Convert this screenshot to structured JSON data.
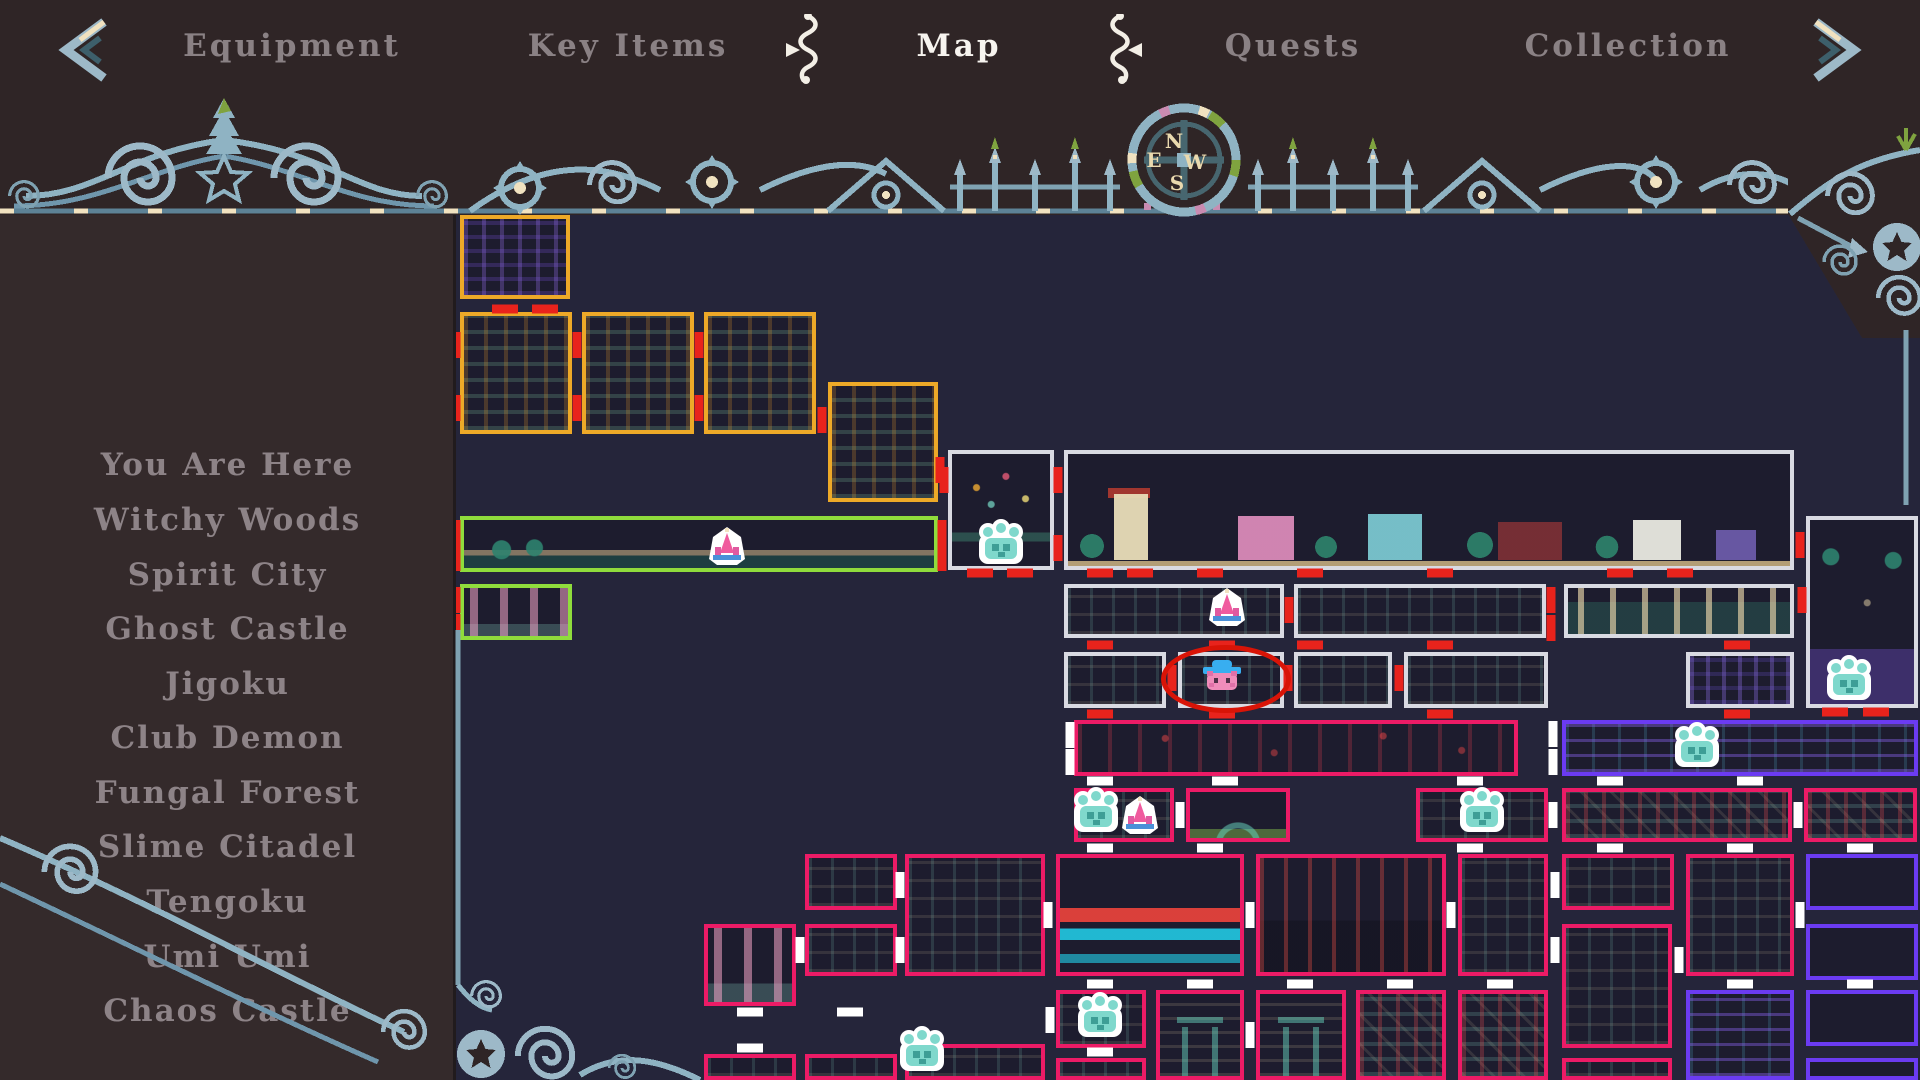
{
  "nav": {
    "tabs": [
      {
        "label": "Equipment",
        "active": false,
        "cx": 292
      },
      {
        "label": "Key Items",
        "active": false,
        "cx": 628
      },
      {
        "label": "Map",
        "active": true,
        "cx": 959
      },
      {
        "label": "Quests",
        "active": false,
        "cx": 1293
      },
      {
        "label": "Collection",
        "active": false,
        "cx": 1628
      }
    ]
  },
  "sidebar": {
    "items": [
      "You Are Here",
      "Witchy Woods",
      "Spirit City",
      "Ghost Castle",
      "Jigoku",
      "Club Demon",
      "Fungal Forest",
      "Slime Citadel",
      "Tengoku",
      "Umi Umi",
      "Chaos Castle"
    ]
  },
  "compass": {
    "north": "N",
    "east": "E",
    "south": "S",
    "west": "W"
  },
  "colors": {
    "orange": "#eda928",
    "green": "#8fdc3c",
    "white": "#d9dae2",
    "pink": "#ec1b66",
    "purple": "#6b3bf2",
    "door_red": "#e8231c",
    "door_white": "#ffffff",
    "ellipse_red": "#d81407",
    "map_bg": "#25253a",
    "panel_bg": "#2f2526",
    "iron_light": "#9db9c8",
    "iron_cream": "#f1e2c0",
    "text_gray": "#8a8184",
    "text_active": "#f7f4ef"
  },
  "map": {
    "room_fields": "x,y,w,h,color,theme",
    "rooms": [
      [
        460,
        215,
        110,
        84,
        "orange",
        "violet"
      ],
      [
        460,
        312,
        112,
        122,
        "orange",
        "forest"
      ],
      [
        582,
        312,
        112,
        122,
        "orange",
        "forest"
      ],
      [
        704,
        312,
        112,
        122,
        "orange",
        "forest"
      ],
      [
        828,
        382,
        110,
        120,
        "orange",
        "forest"
      ],
      [
        460,
        516,
        478,
        56,
        "green",
        "meadow"
      ],
      [
        460,
        584,
        112,
        56,
        "green",
        "shrine"
      ],
      [
        948,
        450,
        106,
        120,
        "white",
        "carnival"
      ],
      [
        1064,
        450,
        730,
        120,
        "white",
        "skyline"
      ],
      [
        1806,
        516,
        112,
        192,
        "white",
        "park"
      ],
      [
        1064,
        584,
        220,
        54,
        "white",
        "cave"
      ],
      [
        1294,
        584,
        252,
        54,
        "white",
        "cave"
      ],
      [
        1564,
        584,
        230,
        54,
        "white",
        "colonnade"
      ],
      [
        1064,
        652,
        102,
        56,
        "white",
        "cave"
      ],
      [
        1178,
        652,
        106,
        56,
        "white",
        "cave"
      ],
      [
        1294,
        652,
        98,
        56,
        "white",
        "cave"
      ],
      [
        1404,
        652,
        144,
        56,
        "white",
        "cave"
      ],
      [
        1686,
        652,
        108,
        56,
        "white",
        "ruins"
      ],
      [
        1074,
        720,
        444,
        56,
        "pink",
        "clouds"
      ],
      [
        1562,
        720,
        356,
        56,
        "purple",
        "pipes"
      ],
      [
        1074,
        788,
        100,
        54,
        "pink",
        "cave"
      ],
      [
        1186,
        788,
        104,
        54,
        "pink",
        "arch"
      ],
      [
        1416,
        788,
        132,
        54,
        "pink",
        "cave"
      ],
      [
        1562,
        788,
        230,
        54,
        "pink",
        "speckle"
      ],
      [
        1804,
        788,
        113,
        54,
        "pink",
        "speckle"
      ],
      [
        1056,
        854,
        188,
        122,
        "pink",
        "casino"
      ],
      [
        1256,
        854,
        190,
        122,
        "pink",
        "night"
      ],
      [
        1458,
        854,
        90,
        122,
        "pink",
        "cave"
      ],
      [
        1562,
        854,
        112,
        56,
        "pink",
        "cave"
      ],
      [
        1562,
        924,
        110,
        124,
        "pink",
        "cave"
      ],
      [
        1686,
        854,
        108,
        122,
        "pink",
        "cave"
      ],
      [
        1806,
        854,
        112,
        56,
        "purple",
        "arches"
      ],
      [
        1806,
        924,
        112,
        56,
        "purple",
        "arches"
      ],
      [
        805,
        854,
        92,
        56,
        "pink",
        "cave"
      ],
      [
        704,
        924,
        92,
        82,
        "pink",
        "shrine"
      ],
      [
        805,
        924,
        92,
        52,
        "pink",
        "cave"
      ],
      [
        905,
        854,
        140,
        122,
        "pink",
        "cave"
      ],
      [
        905,
        1044,
        140,
        36,
        "pink",
        "cave"
      ],
      [
        704,
        1054,
        92,
        26,
        "pink",
        "cave"
      ],
      [
        805,
        1054,
        92,
        26,
        "pink",
        "cave"
      ],
      [
        1056,
        990,
        90,
        58,
        "pink",
        "cave"
      ],
      [
        1156,
        990,
        88,
        90,
        "pink",
        "gate"
      ],
      [
        1256,
        990,
        90,
        90,
        "pink",
        "gate"
      ],
      [
        1356,
        990,
        90,
        90,
        "pink",
        "speckle"
      ],
      [
        1458,
        990,
        90,
        90,
        "pink",
        "speckle"
      ],
      [
        1562,
        1058,
        110,
        22,
        "pink",
        "cave"
      ],
      [
        1056,
        1058,
        90,
        22,
        "pink",
        "cave"
      ],
      [
        1686,
        990,
        108,
        90,
        "purple",
        "pipes"
      ],
      [
        1806,
        990,
        112,
        56,
        "purple",
        "arches"
      ],
      [
        1806,
        1058,
        112,
        22,
        "purple",
        "arches"
      ]
    ],
    "door_fields": "x,y,orientation,color(r=red,w=white)",
    "doors": [
      [
        505,
        309,
        "v",
        "r"
      ],
      [
        545,
        309,
        "v",
        "r"
      ],
      [
        577,
        345,
        "h",
        "r"
      ],
      [
        577,
        408,
        "h",
        "r"
      ],
      [
        699,
        345,
        "h",
        "r"
      ],
      [
        699,
        408,
        "h",
        "r"
      ],
      [
        822,
        420,
        "h",
        "r"
      ],
      [
        940,
        470,
        "h",
        "r"
      ],
      [
        456,
        345,
        "h",
        "r"
      ],
      [
        456,
        408,
        "h",
        "r"
      ],
      [
        456,
        533,
        "h",
        "r"
      ],
      [
        456,
        558,
        "h",
        "r"
      ],
      [
        942,
        533,
        "h",
        "r"
      ],
      [
        942,
        558,
        "h",
        "r"
      ],
      [
        456,
        600,
        "h",
        "r"
      ],
      [
        456,
        627,
        "h",
        "r"
      ],
      [
        1058,
        480,
        "h",
        "r"
      ],
      [
        1058,
        548,
        "h",
        "r"
      ],
      [
        944,
        480,
        "h",
        "r"
      ],
      [
        980,
        573,
        "v",
        "r"
      ],
      [
        1020,
        573,
        "v",
        "r"
      ],
      [
        1100,
        573,
        "v",
        "r"
      ],
      [
        1140,
        573,
        "v",
        "r"
      ],
      [
        1210,
        573,
        "v",
        "r"
      ],
      [
        1310,
        573,
        "v",
        "r"
      ],
      [
        1440,
        573,
        "v",
        "r"
      ],
      [
        1620,
        573,
        "v",
        "r"
      ],
      [
        1680,
        573,
        "v",
        "r"
      ],
      [
        1800,
        545,
        "h",
        "r"
      ],
      [
        1802,
        600,
        "h",
        "r"
      ],
      [
        1289,
        610,
        "h",
        "r"
      ],
      [
        1551,
        600,
        "h",
        "r"
      ],
      [
        1551,
        628,
        "h",
        "r"
      ],
      [
        1100,
        645,
        "v",
        "r"
      ],
      [
        1222,
        645,
        "v",
        "r"
      ],
      [
        1310,
        645,
        "v",
        "r"
      ],
      [
        1440,
        645,
        "v",
        "r"
      ],
      [
        1737,
        645,
        "v",
        "r"
      ],
      [
        1172,
        678,
        "h",
        "r"
      ],
      [
        1288,
        678,
        "h",
        "r"
      ],
      [
        1399,
        678,
        "h",
        "r"
      ],
      [
        1835,
        712,
        "v",
        "r"
      ],
      [
        1876,
        712,
        "v",
        "r"
      ],
      [
        1100,
        714,
        "v",
        "r"
      ],
      [
        1222,
        714,
        "v",
        "r"
      ],
      [
        1440,
        714,
        "v",
        "r"
      ],
      [
        1737,
        714,
        "v",
        "r"
      ],
      [
        1553,
        734,
        "h",
        "w"
      ],
      [
        1553,
        762,
        "h",
        "w"
      ],
      [
        1070,
        735,
        "h",
        "w"
      ],
      [
        1070,
        762,
        "h",
        "w"
      ],
      [
        1100,
        781,
        "v",
        "w"
      ],
      [
        1225,
        781,
        "v",
        "w"
      ],
      [
        1470,
        781,
        "v",
        "w"
      ],
      [
        1610,
        781,
        "v",
        "w"
      ],
      [
        1750,
        781,
        "v",
        "w"
      ],
      [
        1180,
        815,
        "h",
        "w"
      ],
      [
        1553,
        815,
        "h",
        "w"
      ],
      [
        1798,
        815,
        "h",
        "w"
      ],
      [
        1100,
        848,
        "v",
        "w"
      ],
      [
        1210,
        848,
        "v",
        "w"
      ],
      [
        1470,
        848,
        "v",
        "w"
      ],
      [
        1610,
        848,
        "v",
        "w"
      ],
      [
        1740,
        848,
        "v",
        "w"
      ],
      [
        1860,
        848,
        "v",
        "w"
      ],
      [
        1250,
        915,
        "h",
        "w"
      ],
      [
        1451,
        915,
        "h",
        "w"
      ],
      [
        1555,
        885,
        "h",
        "w"
      ],
      [
        1555,
        950,
        "h",
        "w"
      ],
      [
        1679,
        960,
        "h",
        "w"
      ],
      [
        1800,
        915,
        "h",
        "w"
      ],
      [
        900,
        885,
        "h",
        "w"
      ],
      [
        800,
        950,
        "h",
        "w"
      ],
      [
        900,
        950,
        "h",
        "w"
      ],
      [
        1048,
        915,
        "h",
        "w"
      ],
      [
        1100,
        984,
        "v",
        "w"
      ],
      [
        1200,
        984,
        "v",
        "w"
      ],
      [
        1300,
        984,
        "v",
        "w"
      ],
      [
        1400,
        984,
        "v",
        "w"
      ],
      [
        1500,
        984,
        "v",
        "w"
      ],
      [
        750,
        1012,
        "v",
        "w"
      ],
      [
        750,
        1048,
        "v",
        "w"
      ],
      [
        850,
        1012,
        "v",
        "w"
      ],
      [
        1050,
        1020,
        "h",
        "w"
      ],
      [
        1100,
        1052,
        "v",
        "w"
      ],
      [
        1250,
        1035,
        "h",
        "w"
      ],
      [
        1740,
        984,
        "v",
        "w"
      ],
      [
        1860,
        984,
        "v",
        "w"
      ]
    ],
    "badge_fields": "type,x,y",
    "badges": [
      [
        "paw",
        1001,
        545
      ],
      [
        "paw",
        1849,
        681
      ],
      [
        "paw",
        1697,
        748
      ],
      [
        "paw",
        1096,
        813
      ],
      [
        "paw",
        1482,
        813
      ],
      [
        "paw",
        1100,
        1018
      ],
      [
        "paw",
        922,
        1052
      ],
      [
        "landmark",
        727,
        549
      ],
      [
        "landmark",
        1227,
        610
      ],
      [
        "landmark",
        1140,
        818
      ],
      [
        "player",
        1222,
        678
      ]
    ],
    "current_location_ellipse": {
      "cx": 1226,
      "cy": 679
    }
  }
}
